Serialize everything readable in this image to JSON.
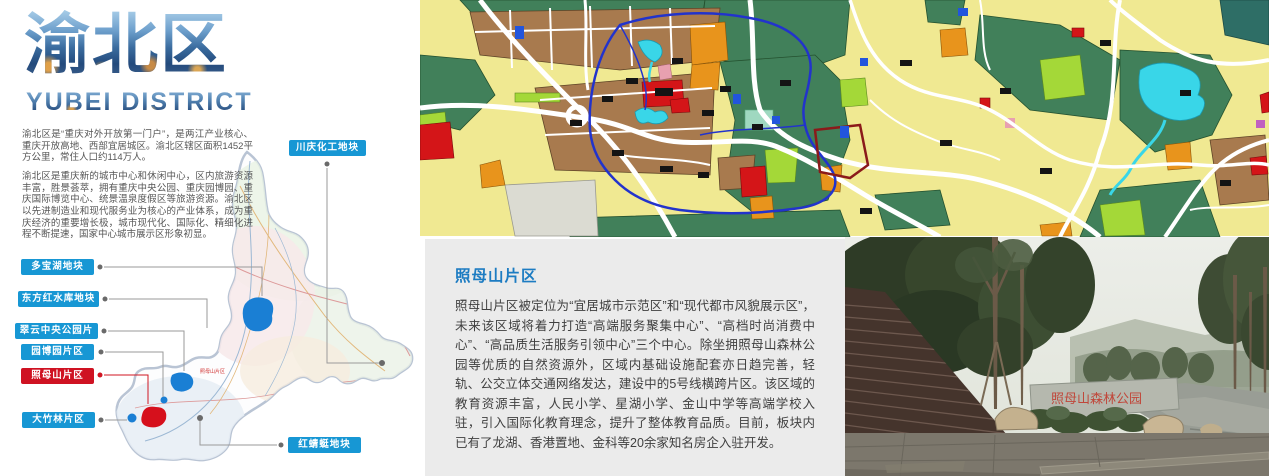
{
  "hero": {
    "title": "渝北区",
    "subtitle": "YUBEI DISTRICT"
  },
  "intro": {
    "para1": "渝北区是“重庆对外开放第一门户”，是两江产业核心、重庆开放高地、西部宜居城区。渝北区辖区面积1452平方公里，常住人口约114万人。",
    "para2": "渝北区是重庆新的城市中心和休闲中心，区内旅游资源丰富，胜景荟萃，拥有重庆中央公园、重庆园博园、重庆国际博览中心、统景温泉度假区等旅游资源。渝北区以先进制造业和现代服务业为核心的产业体系，成为重庆经济的重要增长极，城市现代化、国际化、精细化进程不断提速，国家中心城市展示区形象初显。"
  },
  "district_map": {
    "map_note": "照母山片区",
    "labels": [
      {
        "text": "川庆化工地块",
        "style": "blue"
      },
      {
        "text": "多宝湖地块",
        "style": "blue"
      },
      {
        "text": "东方红水库地块",
        "style": "blue"
      },
      {
        "text": "翠云中央公园片区",
        "style": "blue"
      },
      {
        "text": "园博园片区",
        "style": "blue"
      },
      {
        "text": "照母山片区",
        "style": "red"
      },
      {
        "text": "大竹林片区",
        "style": "blue"
      },
      {
        "text": "红蜻蜓地块",
        "style": "blue"
      }
    ]
  },
  "section": {
    "title": "照母山片区",
    "body": "照母山片区被定位为“宜居城市示范区”和“现代都市风貌展示区”，未来该区域将着力打造“高端服务聚集中心”、“高档时尚消费中心”、“高品质生活服务引领中心”三个中心。除坐拥照母山森林公园等优质的自然资源外，区域内基础设施配套亦日趋完善，轻轨、公交立体交通网络发达，建设中的5号线横跨片区。该区域的教育资源丰富，人民小学、星湖小学、金山中学等高端学校入驻，引入国际化教育理念，提升了整体教育品质。目前，板块内已有了龙湖、香港置地、金科等20余家知名房企入驻开发。"
  },
  "photo": {
    "wall_text": "照母山森林公园"
  },
  "colors": {
    "label_blue": "#1797d4",
    "label_red": "#cf1222",
    "heading_blue": "#1d7cc2",
    "panel_gray": "#ebebeb"
  }
}
